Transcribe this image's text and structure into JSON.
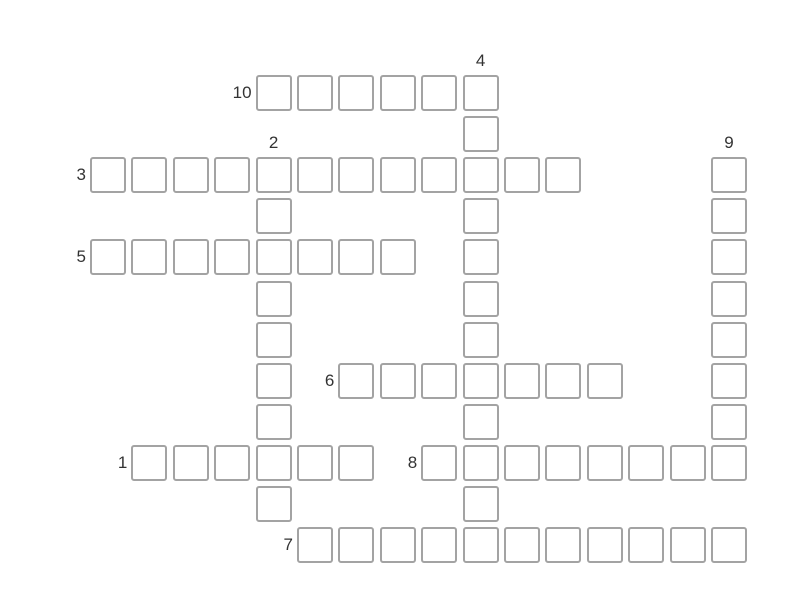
{
  "page": {
    "background": "#ffffff"
  },
  "puzzle": {
    "type": "crossword-grid",
    "grid": {
      "origin_x": 90,
      "origin_y": 75,
      "pitch_x": 41.4,
      "pitch_y": 41.1,
      "cell_size": 36,
      "cell_fill": "#ffffff",
      "cell_border_color": "#a3a3a3",
      "cell_border_width": 2,
      "cell_corner_radius": 3,
      "label_color": "#333333",
      "label_font_size": 17
    },
    "words": [
      {
        "number": "1",
        "direction": "across",
        "row": 9,
        "col": 1,
        "length": 6
      },
      {
        "number": "2",
        "direction": "down",
        "row": 2,
        "col": 4,
        "length": 9
      },
      {
        "number": "3",
        "direction": "across",
        "row": 2,
        "col": 0,
        "length": 12
      },
      {
        "number": "4",
        "direction": "down",
        "row": 0,
        "col": 9,
        "length": 12
      },
      {
        "number": "5",
        "direction": "across",
        "row": 4,
        "col": 0,
        "length": 8
      },
      {
        "number": "6",
        "direction": "across",
        "row": 7,
        "col": 6,
        "length": 7
      },
      {
        "number": "7",
        "direction": "across",
        "row": 11,
        "col": 5,
        "length": 11
      },
      {
        "number": "8",
        "direction": "across",
        "row": 9,
        "col": 8,
        "length": 8
      },
      {
        "number": "9",
        "direction": "down",
        "row": 2,
        "col": 15,
        "length": 8
      },
      {
        "number": "10",
        "direction": "across",
        "row": 0,
        "col": 4,
        "length": 6
      }
    ],
    "cell_values": ""
  }
}
